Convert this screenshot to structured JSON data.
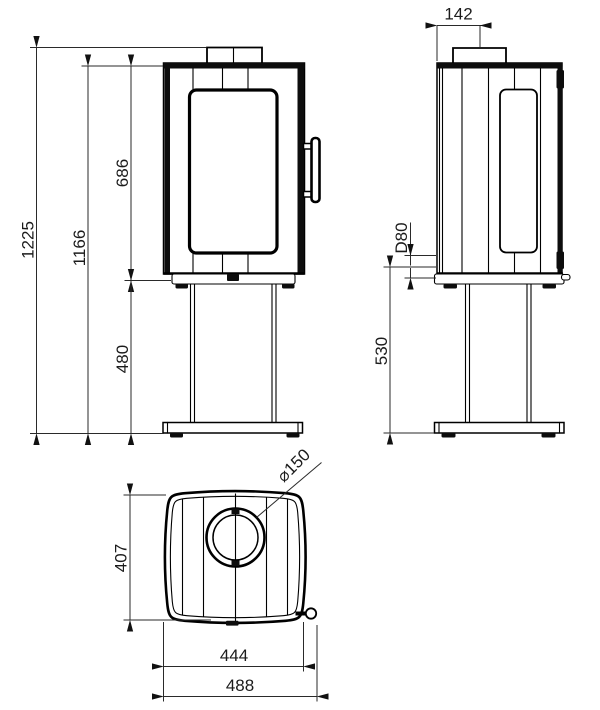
{
  "drawing": {
    "type": "technical-drawing",
    "subject": "pedestal stove orthographic views (front, side, top)",
    "units": "mm",
    "colors": {
      "line": "#000000",
      "dimension": "#2a2a2a",
      "background": "#ffffff"
    },
    "front_view": {
      "dims": {
        "total_height": "1225",
        "body_top_height": "1166",
        "firebox_height": "686",
        "pedestal_height": "480"
      }
    },
    "side_view": {
      "dims": {
        "flue_offset": "142",
        "intake_diameter": "D80",
        "intake_center_height": "530"
      }
    },
    "top_view": {
      "dims": {
        "depth": "407",
        "body_width": "444",
        "overall_width": "488",
        "flue_diameter": "⌀150"
      }
    }
  }
}
